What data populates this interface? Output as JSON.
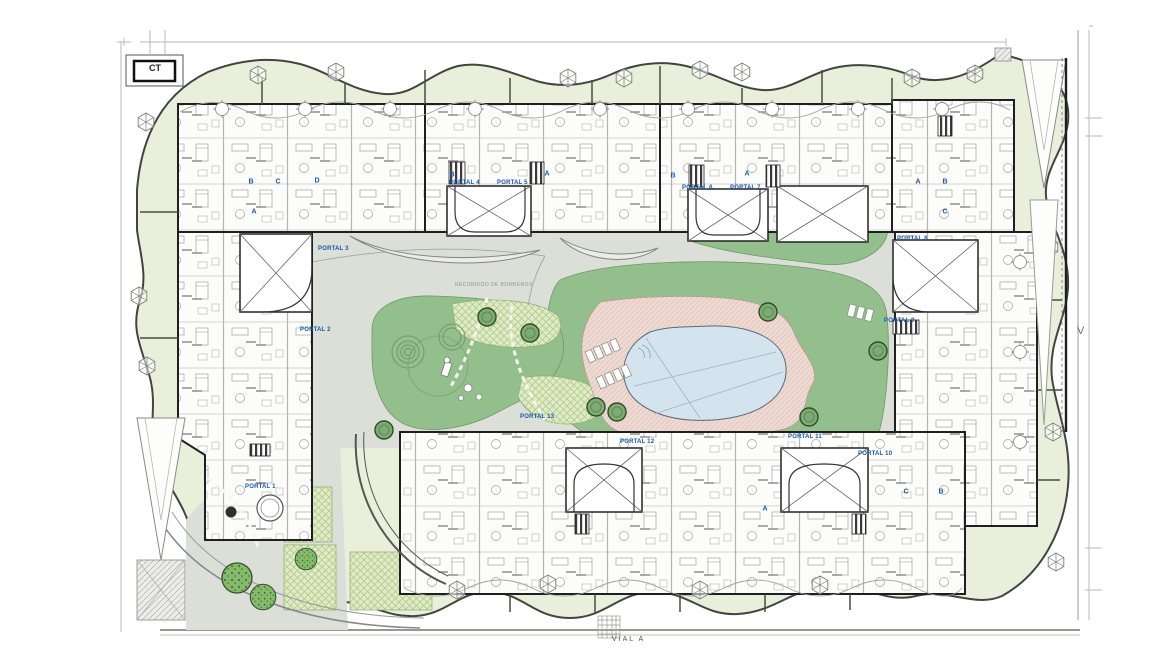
{
  "plan": {
    "labels": {
      "ct": "CT",
      "v": "V",
      "road": "VIAL A",
      "fire_route": "RECORRIDO DE BOMBEROS"
    },
    "portals": [
      {
        "label": "PORTAL 1",
        "x": 245,
        "y": 484
      },
      {
        "label": "PORTAL 2",
        "x": 300,
        "y": 327
      },
      {
        "label": "PORTAL 3",
        "x": 318,
        "y": 246
      },
      {
        "label": "PORTAL 4",
        "x": 449,
        "y": 180
      },
      {
        "label": "PORTAL 5",
        "x": 497,
        "y": 180
      },
      {
        "label": "PORTAL 6",
        "x": 682,
        "y": 185
      },
      {
        "label": "PORTAL 7",
        "x": 730,
        "y": 185
      },
      {
        "label": "PORTAL 8",
        "x": 897,
        "y": 236
      },
      {
        "label": "PORTAL 9",
        "x": 884,
        "y": 318
      },
      {
        "label": "PORTAL 10",
        "x": 858,
        "y": 451
      },
      {
        "label": "PORTAL 11",
        "x": 788,
        "y": 434
      },
      {
        "label": "PORTAL 12",
        "x": 620,
        "y": 439
      },
      {
        "label": "PORTAL 13",
        "x": 520,
        "y": 414
      }
    ],
    "unit_letters": [
      {
        "t": "B",
        "x": 251,
        "y": 182
      },
      {
        "t": "C",
        "x": 278,
        "y": 182
      },
      {
        "t": "D",
        "x": 317,
        "y": 181
      },
      {
        "t": "A",
        "x": 254,
        "y": 212
      },
      {
        "t": "B",
        "x": 452,
        "y": 175
      },
      {
        "t": "A",
        "x": 547,
        "y": 174
      },
      {
        "t": "B",
        "x": 673,
        "y": 176
      },
      {
        "t": "A",
        "x": 747,
        "y": 174
      },
      {
        "t": "A",
        "x": 918,
        "y": 182
      },
      {
        "t": "B",
        "x": 945,
        "y": 182
      },
      {
        "t": "C",
        "x": 945,
        "y": 212
      },
      {
        "t": "C",
        "x": 906,
        "y": 492
      },
      {
        "t": "B",
        "x": 941,
        "y": 492
      },
      {
        "t": "A",
        "x": 765,
        "y": 509
      }
    ],
    "colors": {
      "perimeter_green": "#e9efda",
      "lawn_green": "#93bf8d",
      "planting_hatch": "#e0ebc6",
      "plaza_grey": "#dcded8",
      "pool_blue": "#d3e4ee",
      "deck_pink": "#eedad3",
      "wall_dark": "#1f1f1f",
      "label_blue": "#1a57ae"
    }
  }
}
